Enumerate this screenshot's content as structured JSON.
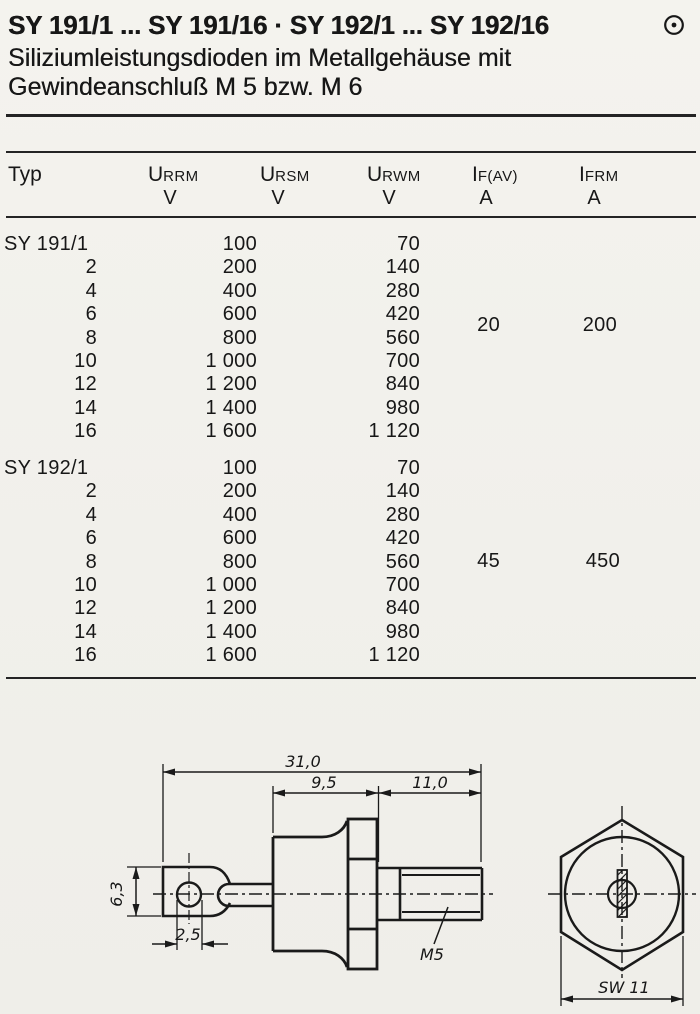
{
  "page": {
    "title": "SY 191/1 ... SY 191/16 · SY 192/1 ... SY 192/16",
    "subtitle": [
      "Siliziumleistungsdioden im Metallgehäuse mit",
      "Gewindeanschluß M 5 bzw. M 6"
    ],
    "corner_icon": "circled-dot"
  },
  "table": {
    "col_typ": "Typ",
    "columns": [
      {
        "sym": "U",
        "sub": "RRM",
        "unit": "V"
      },
      {
        "sym": "U",
        "sub": "RSM",
        "unit": "V"
      },
      {
        "sym": "U",
        "sub": "RWM",
        "unit": "V"
      },
      {
        "sym": "I",
        "sub": "F(AV)",
        "unit": "A"
      },
      {
        "sym": "I",
        "sub": "FRM",
        "unit": "A"
      }
    ],
    "sections": [
      {
        "rows": [
          {
            "typ": "SY 191/1",
            "u_rrm": "100",
            "u_rwm": "70"
          },
          {
            "typ": "2",
            "u_rrm": "200",
            "u_rwm": "140"
          },
          {
            "typ": "4",
            "u_rrm": "400",
            "u_rwm": "280"
          },
          {
            "typ": "6",
            "u_rrm": "600",
            "u_rwm": "420"
          },
          {
            "typ": "8",
            "u_rrm": "800",
            "u_rwm": "560"
          },
          {
            "typ": "10",
            "u_rrm": "1 000",
            "u_rwm": "700"
          },
          {
            "typ": "12",
            "u_rrm": "1 200",
            "u_rwm": "840"
          },
          {
            "typ": "14",
            "u_rrm": "1 400",
            "u_rwm": "980"
          },
          {
            "typ": "16",
            "u_rrm": "1 600",
            "u_rwm": "1 120"
          }
        ],
        "i_fav": "20",
        "i_frm": "200"
      },
      {
        "rows": [
          {
            "typ": "SY 192/1",
            "u_rrm": "100",
            "u_rwm": "70"
          },
          {
            "typ": "2",
            "u_rrm": "200",
            "u_rwm": "140"
          },
          {
            "typ": "4",
            "u_rrm": "400",
            "u_rwm": "280"
          },
          {
            "typ": "6",
            "u_rrm": "600",
            "u_rwm": "420"
          },
          {
            "typ": "8",
            "u_rrm": "800",
            "u_rwm": "560"
          },
          {
            "typ": "10",
            "u_rrm": "1 000",
            "u_rwm": "700"
          },
          {
            "typ": "12",
            "u_rrm": "1 200",
            "u_rwm": "840"
          },
          {
            "typ": "14",
            "u_rrm": "1 400",
            "u_rwm": "980"
          },
          {
            "typ": "16",
            "u_rrm": "1 600",
            "u_rwm": "1 120"
          }
        ],
        "i_fav": "45",
        "i_frm": "450"
      }
    ]
  },
  "drawing": {
    "dim_total": "31,0",
    "dim_body": "9,5",
    "dim_stud": "11,0",
    "dim_tab_height": "6,3",
    "dim_hole": "2,5",
    "thread_label": "M5",
    "wrench_size": "SW 11"
  }
}
